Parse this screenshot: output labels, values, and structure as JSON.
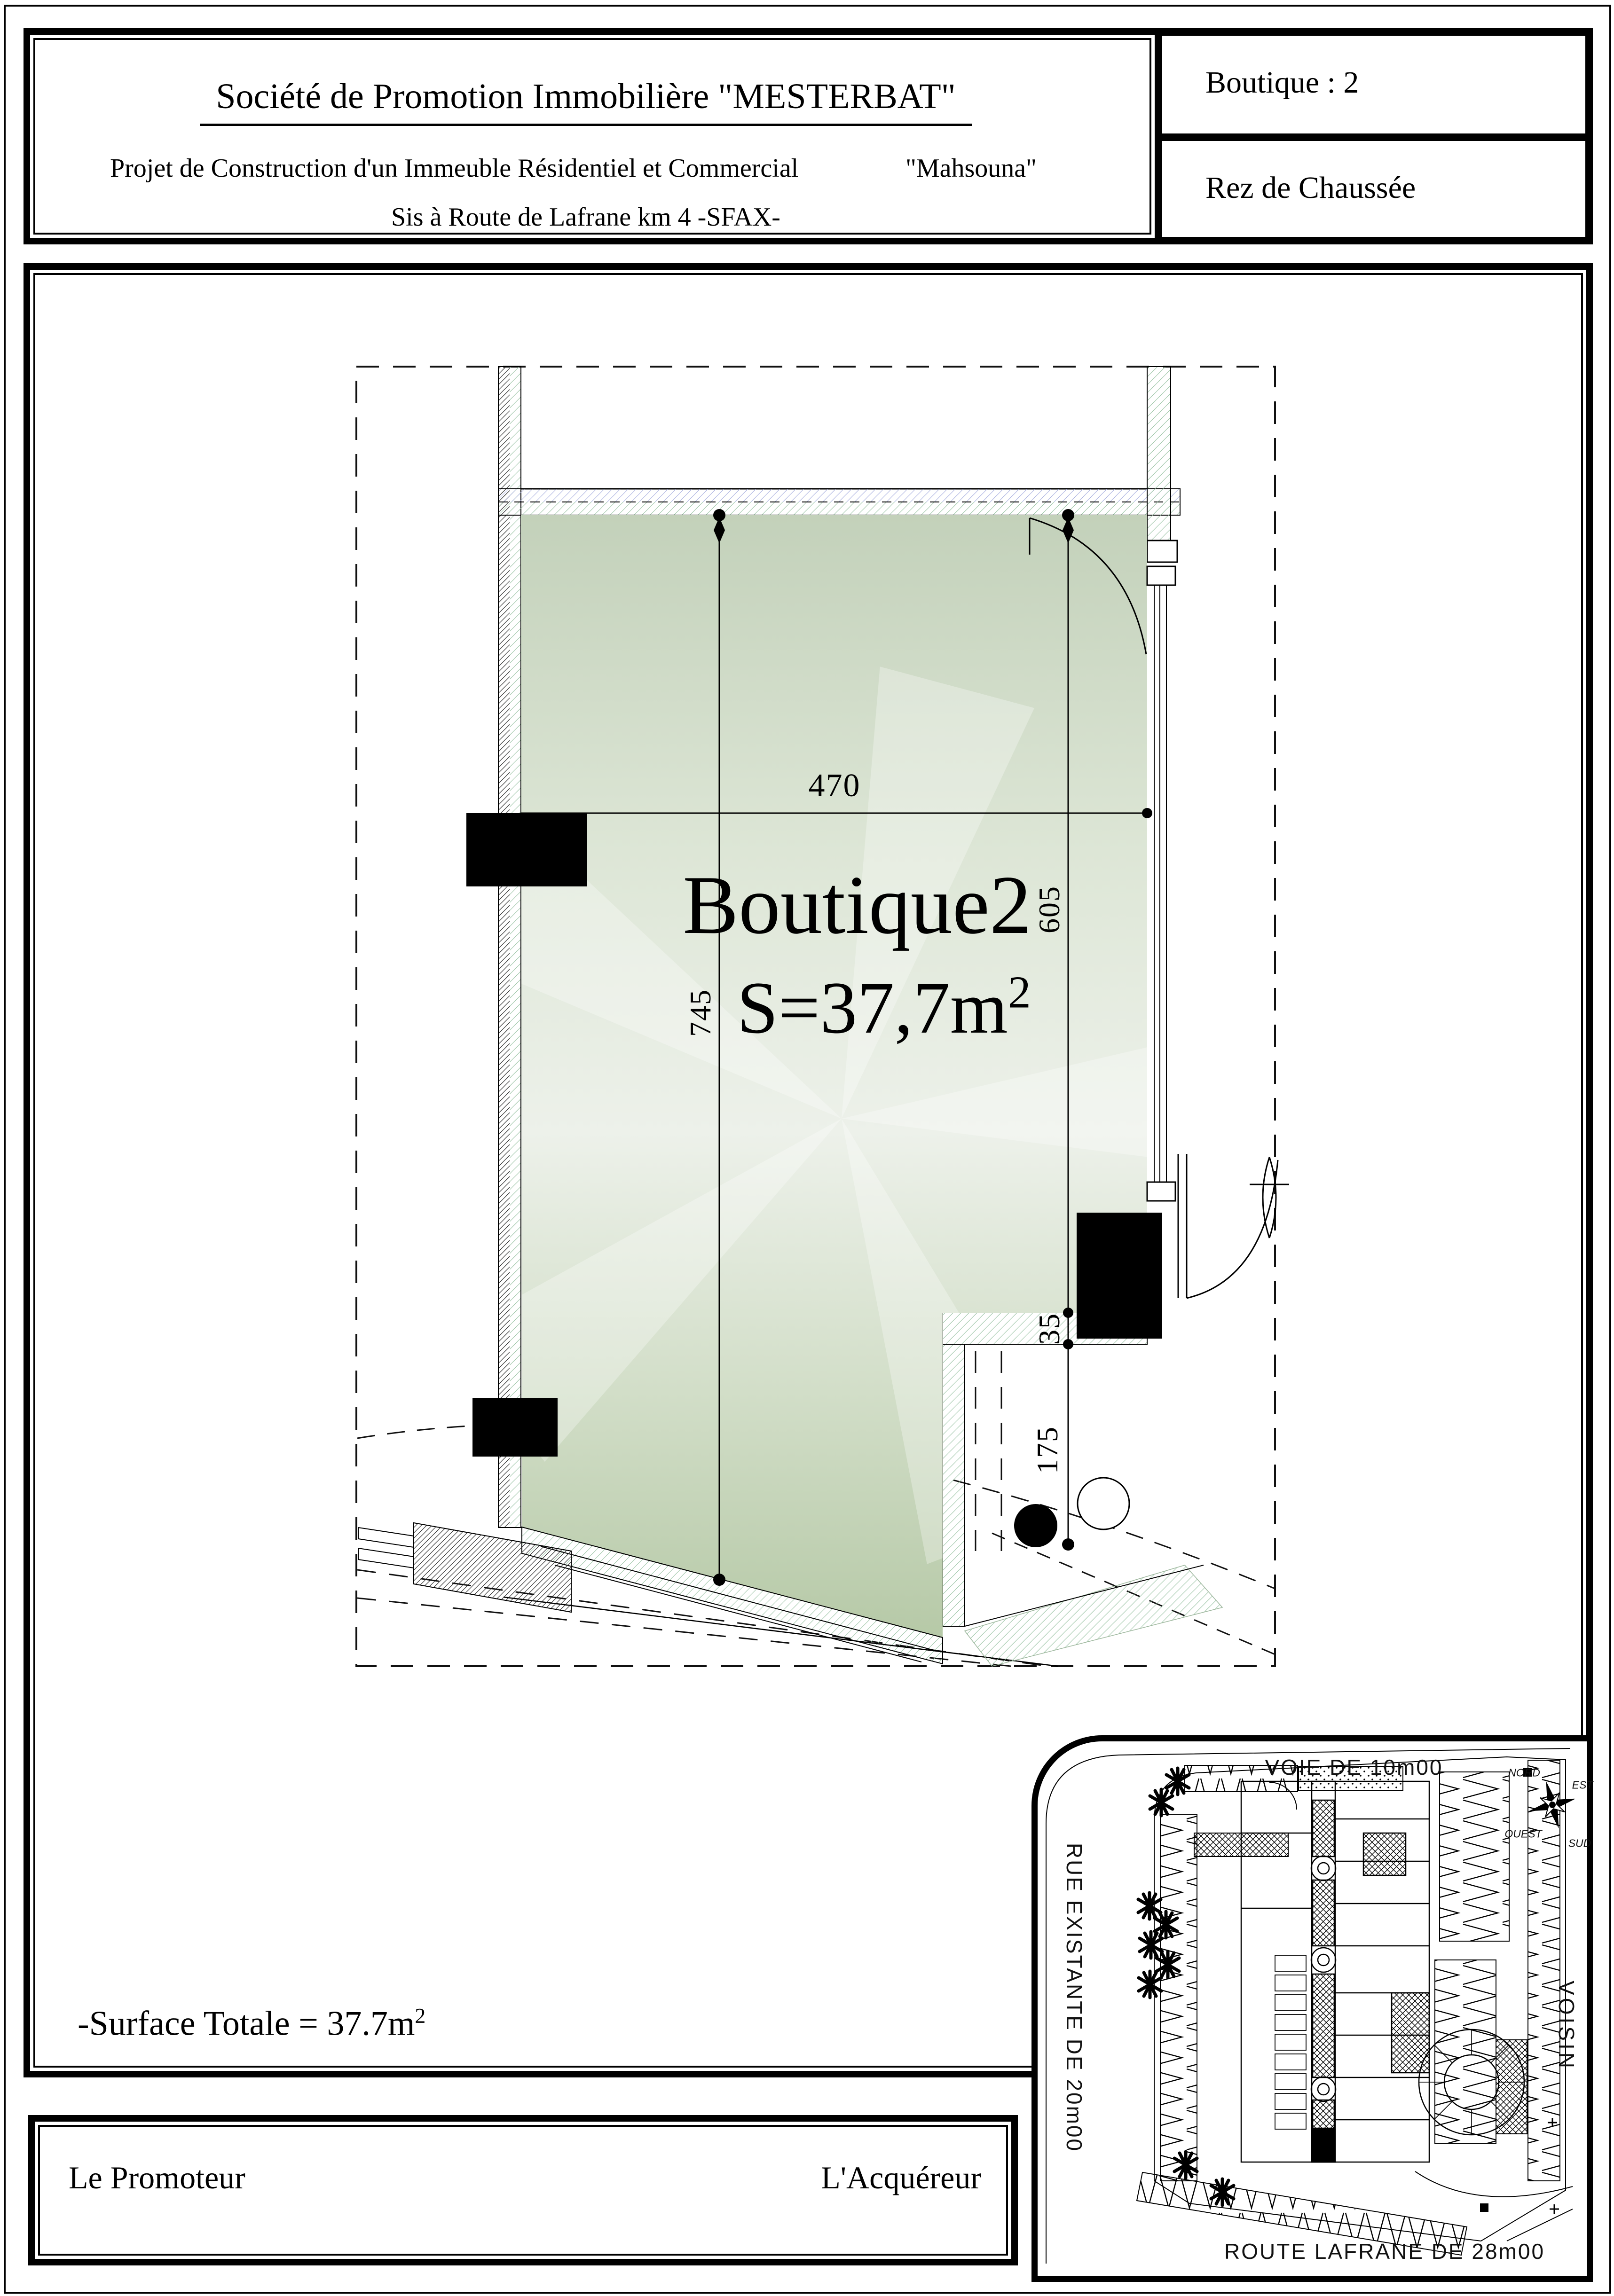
{
  "header": {
    "title": "Société de Promotion Immobilière \"MESTERBAT\"",
    "project_line": "Projet de Construction d'un Immeuble Résidentiel et Commercial",
    "project_name": "\"Mahsouna\"",
    "address_line": "Sis à Route de Lafrane km 4  -SFAX-",
    "unit_label": "Boutique : 2",
    "floor_label": "Rez de Chaussée"
  },
  "plan": {
    "room_name": "Boutique2",
    "room_area_base": "S=37,7m",
    "room_area_sup": "2",
    "dim_width": "470",
    "dim_height_left": "745",
    "dim_height_right": "605",
    "dim_wall": "35",
    "dim_front": "175"
  },
  "footer": {
    "surface_note_base": "-Surface Totale = 37.7m",
    "surface_note_sup": "2",
    "promoter_label": "Le Promoteur",
    "buyer_label": "L'Acquéreur"
  },
  "site_plan": {
    "road_top": "VOIE DE 10m00",
    "road_left": "RUE EXISTANTE DE  20m00",
    "neighbor_right": "VOISIN",
    "road_bottom": "ROUTE LAFRANE  DE  28m00",
    "compass": {
      "north": "NORD",
      "east": "EST",
      "west": "OUEST",
      "south": "SUD"
    }
  },
  "colors": {
    "ink": "#000000",
    "room_green_top": "#c3d1ba",
    "room_green_mid": "#edf1ea",
    "room_green_bottom": "#b6c9a7",
    "hatch_green": "#93bf9e",
    "hatch_blue": "#a2aadd"
  }
}
